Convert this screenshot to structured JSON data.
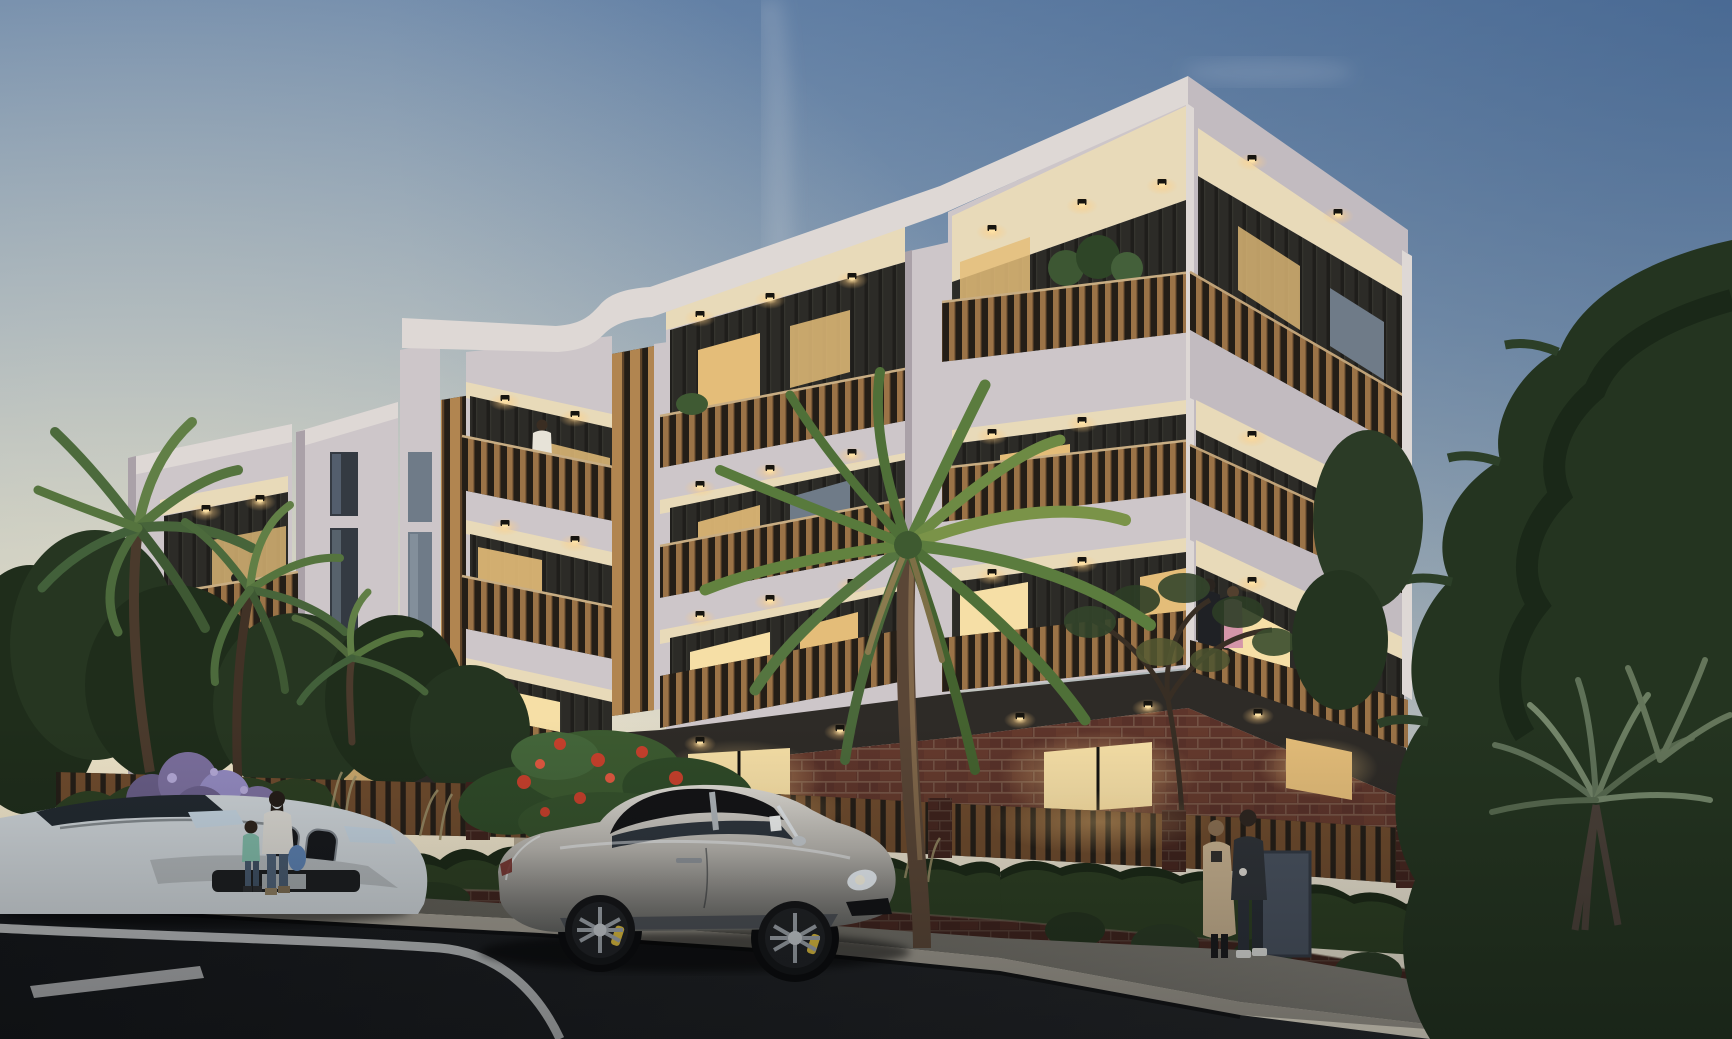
{
  "scene": {
    "type": "architectural exterior render",
    "time_of_day": "dusk",
    "setting": "street-front view of a modern three-storey apartment development with brick podium, lit balconies, parked sports car and pedestrians",
    "weather": "clear evening sky with faint smoke wisp"
  },
  "palette": {
    "sky_top": "#6a87ab",
    "sky_mid": "#93a7ba",
    "sky_low": "#bac3c3",
    "sky_warm": "#e6dfcc",
    "sky_horizon": "#efe8d6",
    "facade_light": "#cdc6c9",
    "facade_bright": "#ded8d5",
    "facade_shadow": "#aaa1a8",
    "facade_side": "#c2bbc0",
    "soffit_warm": "#e8dab9",
    "podium_dark": "#2e2b27",
    "cladding_dark": "#2c2b27",
    "cladding_rib": "#1f1e1b",
    "timber": "#9b7347",
    "timber_light": "#b18550",
    "fence_timber": "#6e4b2d",
    "rail_backing": "#241e17",
    "brick": "#5e352b",
    "brick_dark": "#3f231d",
    "mortar": "#8d7562",
    "window_warm": "#e4bd79",
    "window_bright": "#f6dfa6",
    "window_cool": "#6f7b88",
    "window_dark": "#343a42",
    "hedge_dark": "#1c2917",
    "hedge_mid": "#2c3e22",
    "palm_green": "#557440",
    "palm_dark": "#3c5a2e",
    "conifer": "#243420",
    "foliage_gray": "#607257",
    "purple_bloom": "#8a7fae",
    "flower_red": "#c6402c",
    "grass_dry": "#9a8f68",
    "trunk_brown": "#5a4636",
    "road_far": "#141619",
    "road_near": "#2a2c2f",
    "marking": "#d4d6d7",
    "sidewalk_far": "#535149",
    "sidewalk_near": "#8e8b83",
    "kerb": "#a29d92",
    "car_silver": "#b6b3ad",
    "car_silver_hi": "#e0ddd6",
    "car_silver_lo": "#7b7a76",
    "car_top": "#141416",
    "car_glass": "#2e353d",
    "wheel": "#141517",
    "rim": "#9aa0a6",
    "caliper": "#d9b93c",
    "car_white": "#ccd2d6",
    "skin": "#c9a184",
    "glow": "#ffdf9e"
  },
  "building": {
    "storeys_visible": 3,
    "ground_floor": "red-brick podium with warm lit windows and recessed entry",
    "facade": "off-white rendered frames with deep recessed balconies",
    "details": [
      "vertical timber-slat balustrades",
      "dark vertical metal cladding in balcony recesses",
      "full-height timber louvre screens",
      "curved ogee parapet detail",
      "warm ceiling downlights",
      "balcony planters"
    ]
  },
  "street": {
    "road": "dark asphalt, dusk",
    "markings": [
      "white kerbside lane line",
      "white painted dash bottom-left"
    ],
    "sidewalk": "concrete footpath",
    "fence": "brick piers with vertical timber slat infill",
    "retaining_wall": "red-brick wall with trailing plants",
    "gate": "dark grey pedestrian gate"
  },
  "vehicles": [
    {
      "name": "sports-convertible",
      "color": "silver with black soft top, yellow brake calipers",
      "position": "parked centre foreground, facing right"
    },
    {
      "name": "white-coupe",
      "color": "white",
      "position": "left edge, front three-quarter, partially out of frame"
    }
  ],
  "people": [
    {
      "name": "balcony-couple-left",
      "where": "upper balcony of far-left block"
    },
    {
      "name": "balcony-woman",
      "where": "upper balcony of stepped middle bay, light top"
    },
    {
      "name": "balcony-couple-right",
      "where": "first-floor balcony right wing, man in black tee, woman in pink top"
    },
    {
      "name": "walking-pair-behind-fence",
      "where": "path behind front fence, man in light suit"
    },
    {
      "name": "mother-and-child",
      "where": "left sidewalk, woman with blue bag, child in teal hoodie"
    },
    {
      "name": "standing-couple",
      "where": "right sidewalk in front of gate, woman in beige coat, man in dark suit with white sneakers"
    }
  ],
  "vegetation": [
    {
      "name": "palm-tree-centre"
    },
    {
      "name": "palm-trees-left"
    },
    {
      "name": "small-palm"
    },
    {
      "name": "frangipani-with-red-flowers"
    },
    {
      "name": "purple-flowering-shrub"
    },
    {
      "name": "olive-tree-right"
    },
    {
      "name": "conifer-far-right"
    },
    {
      "name": "pandanus-right"
    },
    {
      "name": "hedge-row"
    },
    {
      "name": "trailing-wall-plants"
    },
    {
      "name": "balcony-plants"
    },
    {
      "name": "dry-grass-tufts"
    }
  ],
  "lighting": {
    "downlights": 30,
    "lit_windows": 18,
    "mood": "warm interior glow against cool dusk"
  }
}
